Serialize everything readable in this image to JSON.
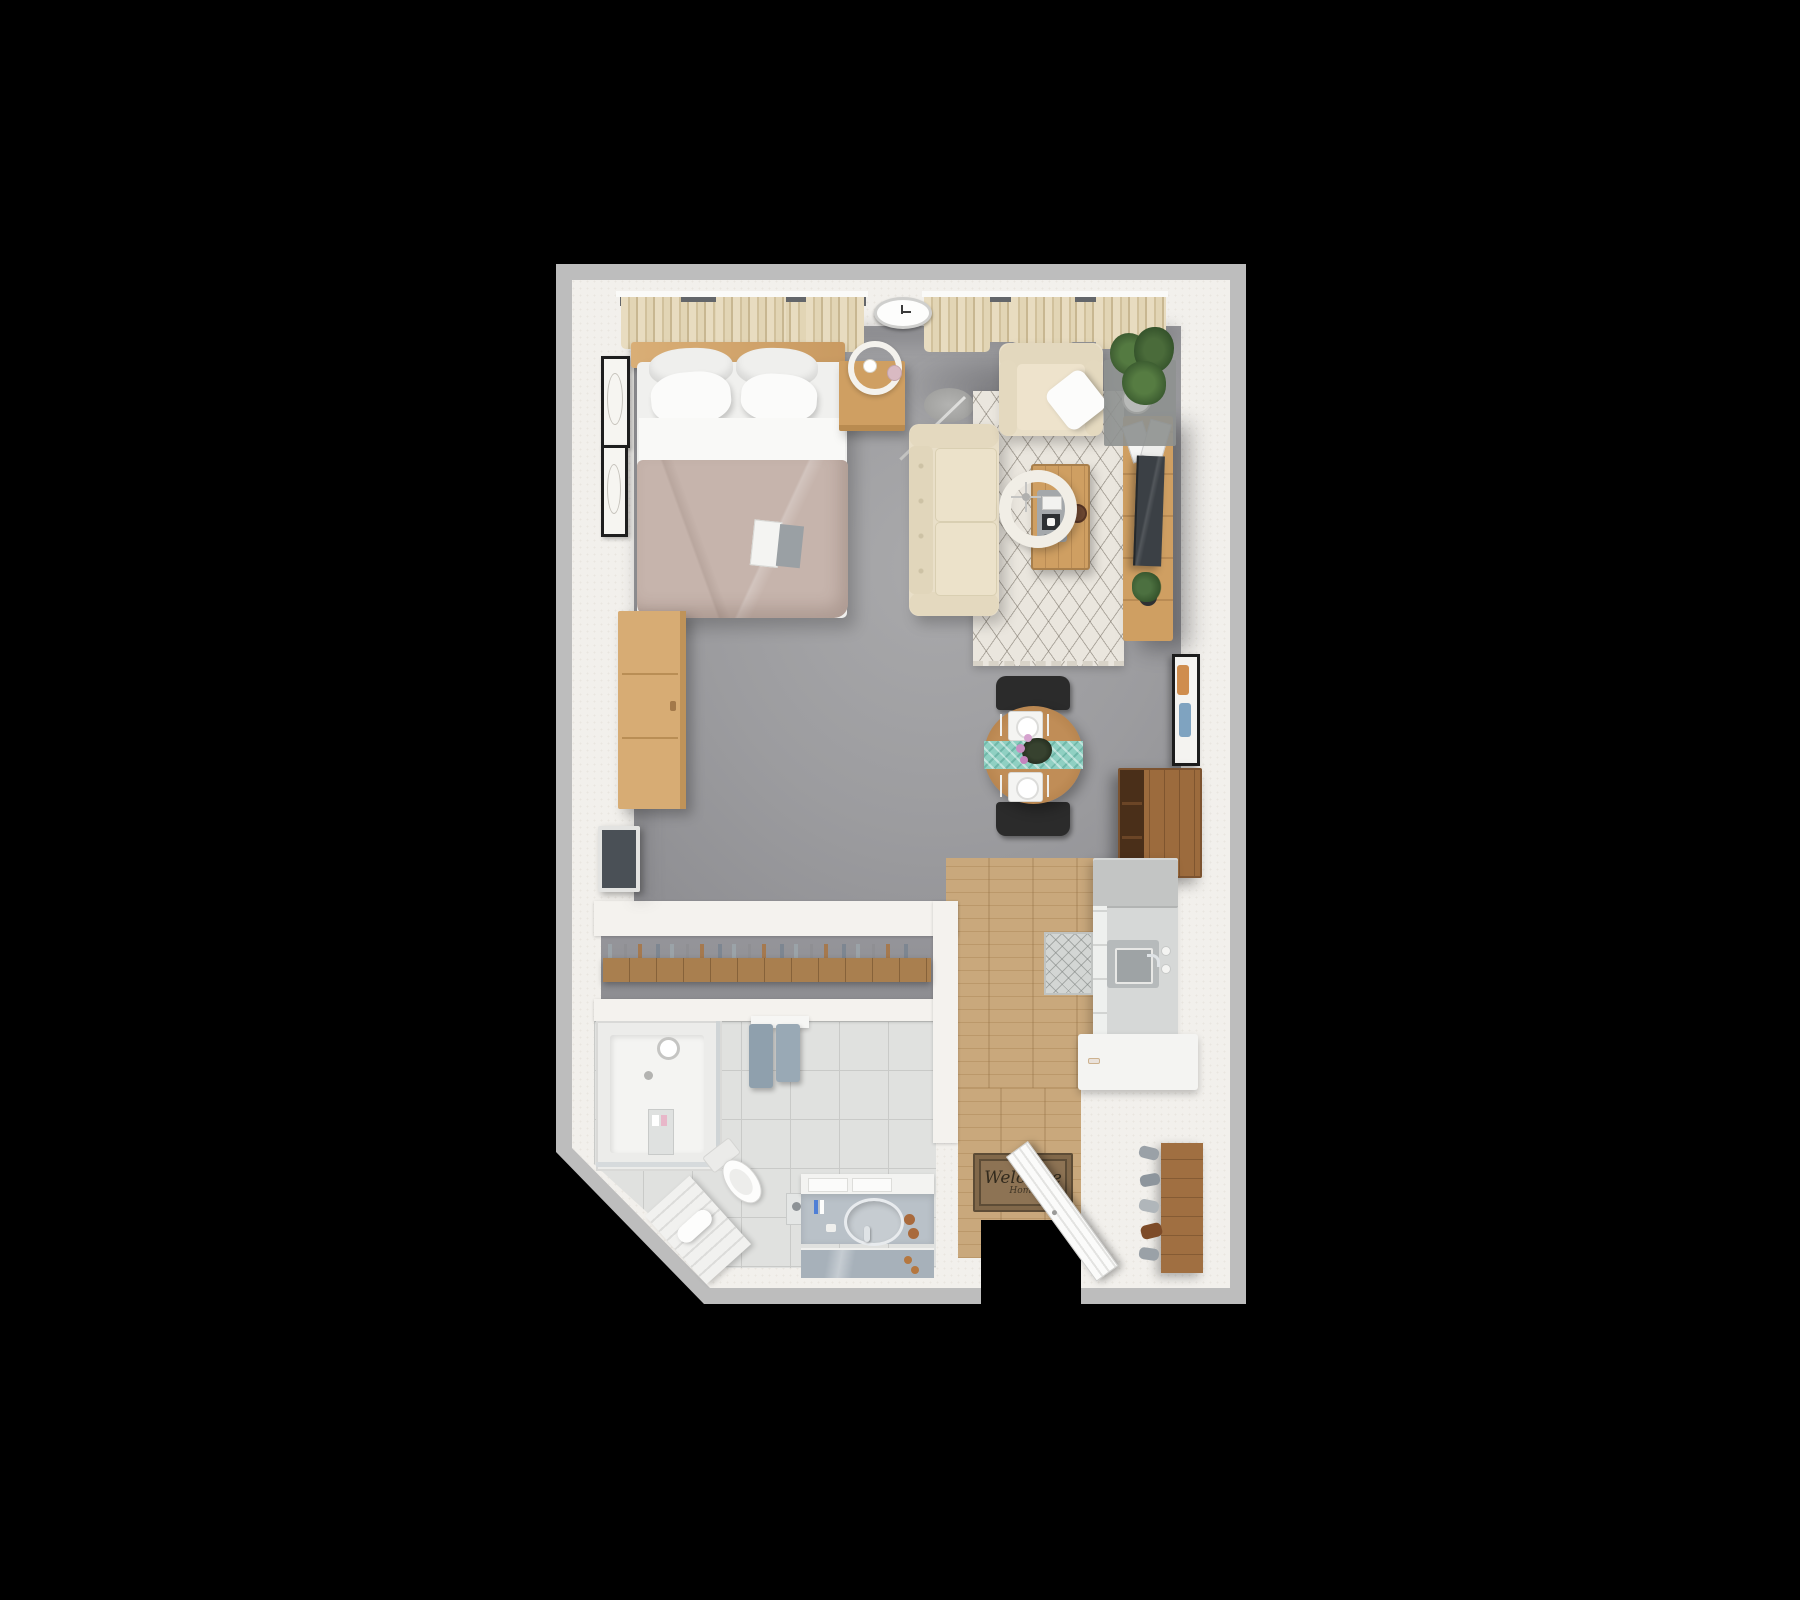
{
  "scene": {
    "type": "3d-floor-plan-top-view",
    "subject": "furnished studio apartment",
    "background": "black",
    "notes": "photoreal top-down 3D render, no dimension text visible"
  },
  "palette": {
    "wall_outer": "#bdbdbd",
    "wall_face": "#f2f0ec",
    "carpet_gray": "#9c9c9f",
    "wood_floor": "#c9a87c",
    "wood_furniture": "#cf9f62",
    "wood_dark": "#9c6b3d",
    "tile": "#e0e1df",
    "sofa_cream": "#e9dfc8",
    "curtain_beige": "#e2d5b5",
    "duvet_taupe": "#c6b4ac",
    "rug_cream": "#eae6de",
    "runner_teal": "#8fd0c2",
    "towel_blue": "#8fa0ad",
    "plant_green": "#45663a",
    "mat_brown": "#8d7354",
    "tv_dark": "#3b4045"
  },
  "labels": {
    "welcome_mat_line1": "Welcome",
    "welcome_mat_line2": "Home"
  },
  "rooms": [
    {
      "name": "sleeping-area",
      "furniture": [
        "queen bed with headboard",
        "4 pillows",
        "white sheet",
        "taupe duvet",
        "magazine on bed",
        "nightstand",
        "ring table lamp",
        "pink cup",
        "dresser",
        "wall-mounted tv",
        "2 picture frames",
        "curtained window"
      ]
    },
    {
      "name": "living-area",
      "furniture": [
        "cream sofa",
        "cream armchair",
        "white throw pillow",
        "arc floor lamp with drum shade",
        "coffee table with tray and bowl",
        "patterned area rug",
        "media console",
        "flat tv on console",
        "magazines",
        "small potted plant",
        "large potted plant",
        "wall clock",
        "framed art on right wall",
        "curtained window"
      ]
    },
    {
      "name": "dining-area",
      "furniture": [
        "round wood table",
        "teal table runner",
        "2 place settings",
        "flower centerpiece",
        "2 black chairs",
        "wall-hung bar cabinet"
      ]
    },
    {
      "name": "kitchen",
      "furniture": [
        "wood plank floor",
        "refrigerator",
        "counter with square sink",
        "faucet with two taps",
        "cabinet fronts",
        "small kitchen rug",
        "white L-shaped peninsula counter"
      ]
    },
    {
      "name": "entry",
      "furniture": [
        "open front door",
        "welcome mat",
        "shoe rack",
        "shoes and boots"
      ]
    },
    {
      "name": "closet-corridor",
      "furniture": [
        "wardrobe shelf",
        "hanging clothes"
      ]
    },
    {
      "name": "bathroom",
      "furniture": [
        "walk-in shower with glass panel",
        "shower head",
        "shower caddy",
        "toilet",
        "bath mat with towel",
        "vanity with oval sink",
        "mirror",
        "toothbrush cups",
        "wall towels",
        "toilet-paper cabinet",
        "tiled floor",
        "angled exterior wall"
      ]
    }
  ]
}
